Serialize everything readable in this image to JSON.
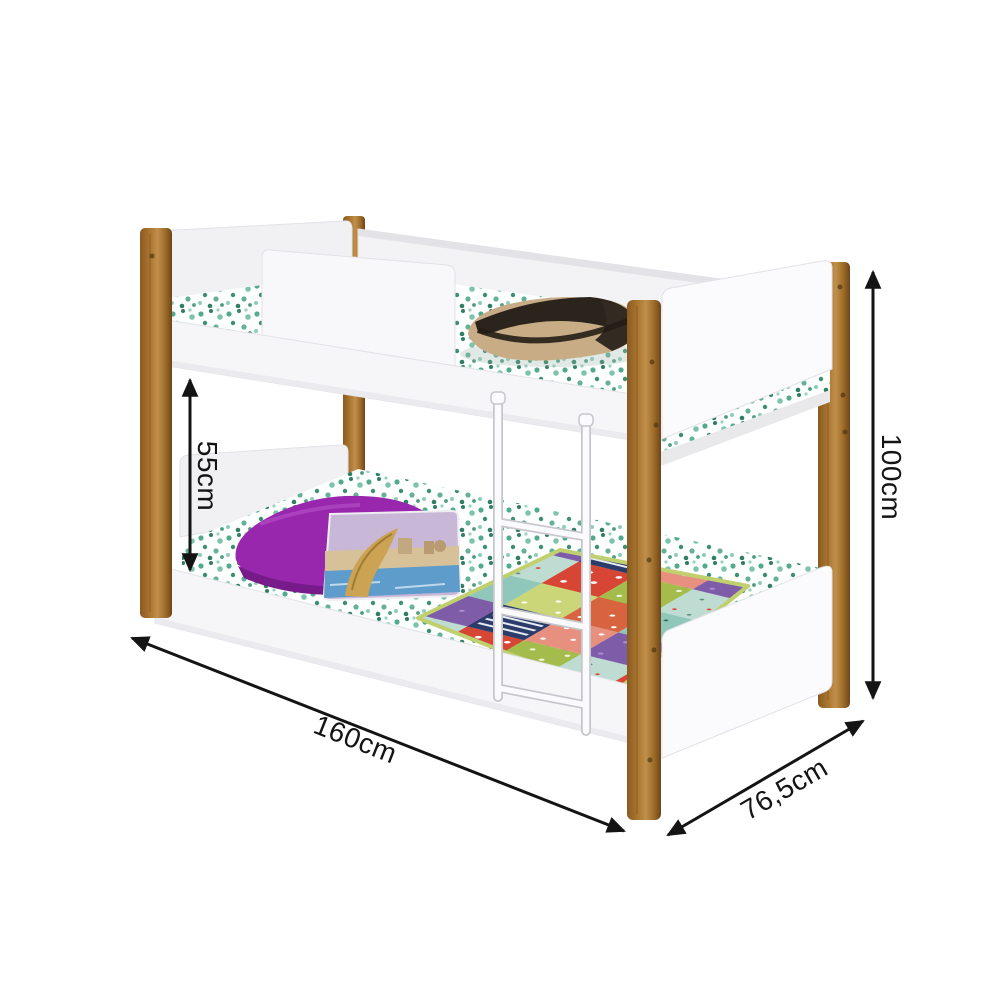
{
  "figure": {
    "type": "product-dimension-diagram",
    "subject": "bunk bed with wooden posts, white panels, two patterned mattresses, pillows, patchwork quilt and hanging ladder",
    "background": "#FFFFFF"
  },
  "dimensions": {
    "clearance": {
      "label": "55cm",
      "orientation": "vertical"
    },
    "height": {
      "label": "100cm",
      "orientation": "vertical"
    },
    "length": {
      "label": "160cm",
      "orientation": "diagonal"
    },
    "depth": {
      "label": "76,5cm",
      "orientation": "diagonal"
    }
  },
  "colors": {
    "annotation": "#141414",
    "wood": "#A9752F",
    "wood_dark": "#6E451A",
    "panel_white": "#F6F6F9",
    "mattress_dot_teal": "#4FA68C",
    "pillow_purple": "#9927AE",
    "cushion_water_blue": "#5E9CCB",
    "cushion_sky": "#C9B7D8",
    "bag_tan": "#C7AC86",
    "quilt_red": "#D74534",
    "quilt_olive": "#A3BC4B",
    "quilt_navy": "#2B3C6B",
    "quilt_salmon": "#E8907F",
    "quilt_purple": "#7F5CA8",
    "quilt_piping": "#C0D06E",
    "ladder_white": "#FBFBFD"
  }
}
